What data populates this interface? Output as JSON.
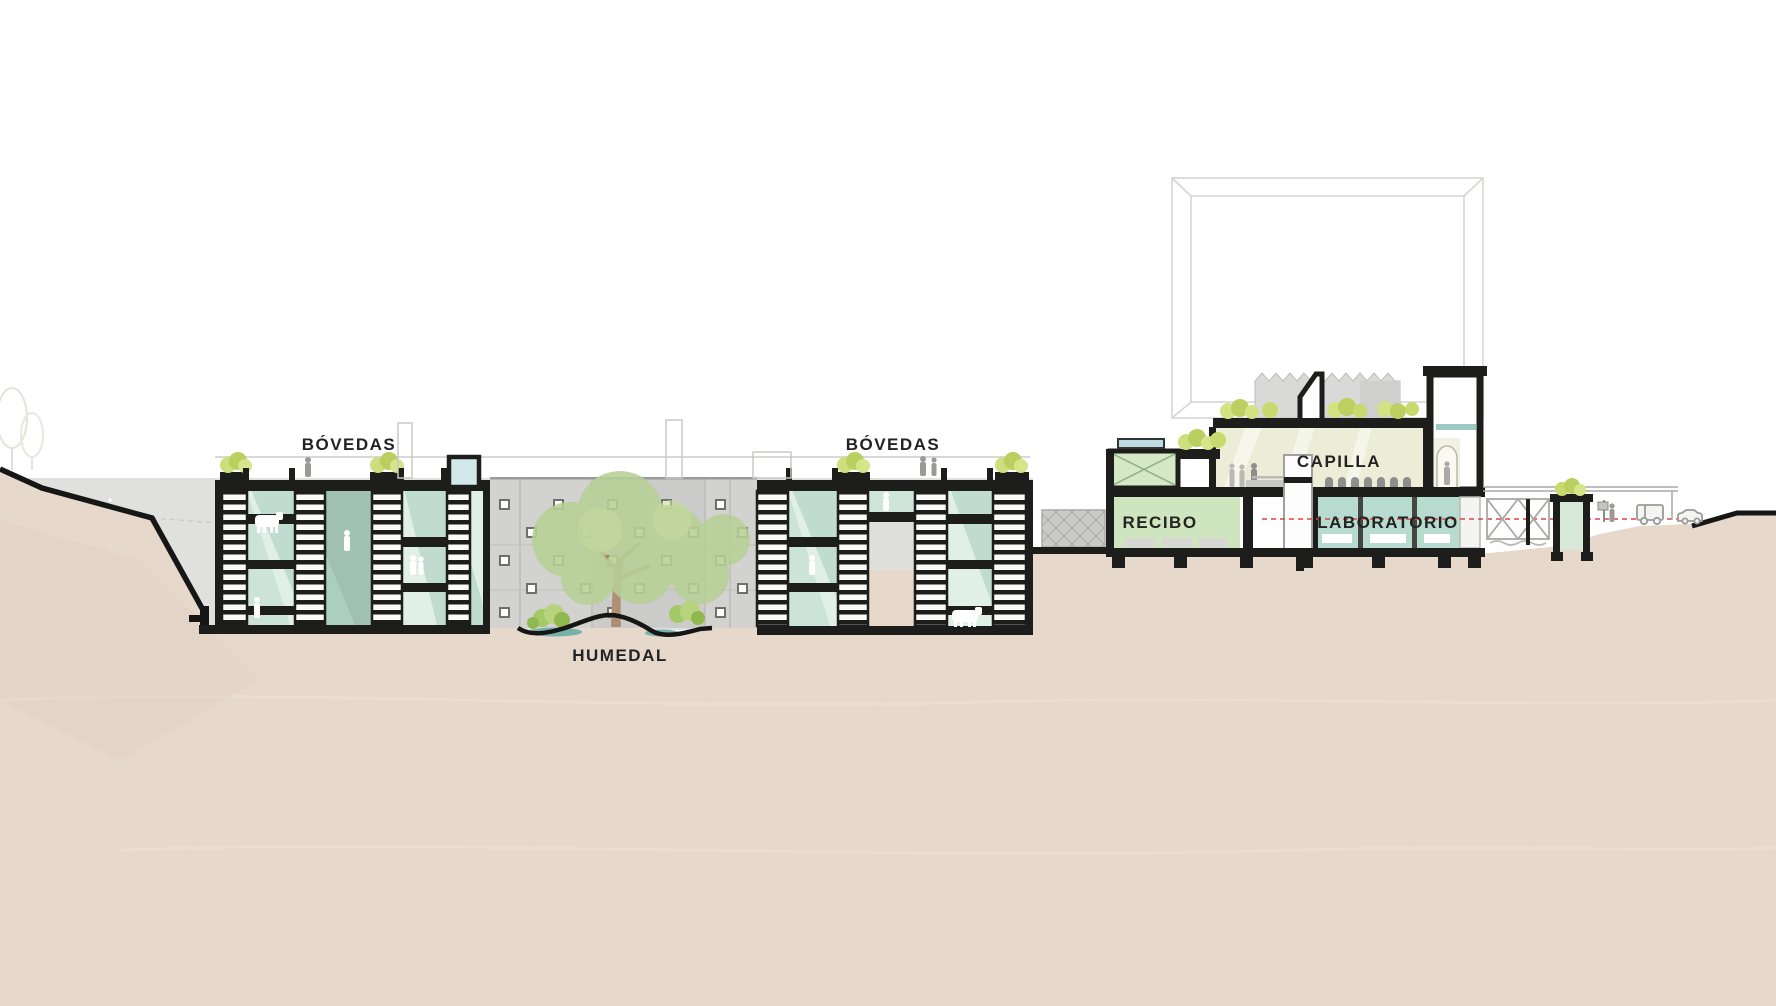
{
  "drawing": {
    "type": "architectural-cross-section",
    "labels": {
      "bovedas_left": "BÓVEDAS",
      "bovedas_right": "BÓVEDAS",
      "humedal": "HUMEDAL",
      "capilla": "CAPILLA",
      "recibo": "RECIBO",
      "laboratorio": "LABORATORIO"
    },
    "palette": {
      "terrain_beige": "#e6d8cb",
      "structure_black": "#1d1d1b",
      "backdrop_gray": "#e0e0de",
      "facade_gray": "#d2d2d0",
      "room_mint": "#e0efe7",
      "shade_teal": "#b2d4c6",
      "shade_dark_teal": "#9fc0b2",
      "tree_green": "#b7d096",
      "planter_green": "#cede7c",
      "shrub_green": "#a6c968",
      "water_teal": "#76b2aa",
      "capilla_cream": "#ecedd6",
      "recibo_green": "#cfe5c0",
      "laboratorio_teal": "#b8dbcf",
      "annex_green": "#d6e9c6",
      "glass_blue": "#bcdbe3",
      "red_guide": "#e04545"
    }
  }
}
